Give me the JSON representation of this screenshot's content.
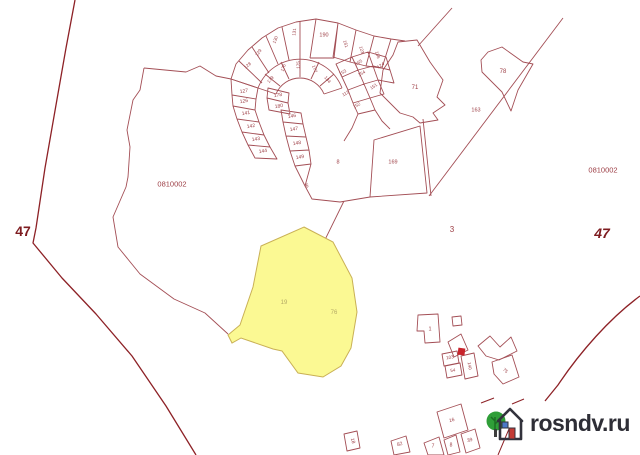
{
  "watermark": {
    "text": "rosndv.ru",
    "logo": "tree-and-house-icon"
  },
  "colors": {
    "parcel_line": "#a34e55",
    "district_line": "#8d2126",
    "district_text": "#7e1c20",
    "label_text": "#9c3d44",
    "highlight_fill": "#fbf993",
    "highlight_stroke": "#c9b055",
    "highlight_label": "#b4aa66",
    "red_marker": "#c8232b",
    "watermark_text": "#2e2e36",
    "tree_green": "#2f9e38"
  },
  "labels": [
    {
      "t": "47",
      "x": 23,
      "y": 231,
      "s": 14,
      "w": "bold",
      "c": "#7e1c20",
      "n": "district-label-left"
    },
    {
      "t": "47",
      "x": 602,
      "y": 233,
      "s": 14,
      "w": "bold",
      "i": true,
      "c": "#7e1c20",
      "n": "district-label-right"
    },
    {
      "t": "0810002",
      "x": 172,
      "y": 184,
      "s": 7.5,
      "n": "quarter-label-left"
    },
    {
      "t": "0810002",
      "x": 603,
      "y": 170,
      "s": 7.5,
      "n": "quarter-label-right"
    },
    {
      "t": "3",
      "x": 452,
      "y": 230,
      "s": 8,
      "n": "area-label"
    },
    {
      "t": "71",
      "x": 415,
      "y": 88,
      "s": 6
    },
    {
      "t": "78",
      "x": 503,
      "y": 72,
      "s": 6
    },
    {
      "t": "163",
      "x": 476,
      "y": 111,
      "s": 5.5
    },
    {
      "t": "169",
      "x": 393,
      "y": 163,
      "s": 5.5
    },
    {
      "t": "6",
      "x": 307,
      "y": 187,
      "s": 5.5
    },
    {
      "t": "8",
      "x": 338,
      "y": 163,
      "s": 5.5
    },
    {
      "t": "127",
      "x": 244,
      "y": 92,
      "s": 5,
      "r": -8
    },
    {
      "t": "126",
      "x": 244,
      "y": 102,
      "s": 5,
      "r": -8
    },
    {
      "t": "141",
      "x": 246,
      "y": 114,
      "s": 5,
      "r": -8
    },
    {
      "t": "142",
      "x": 251,
      "y": 127,
      "s": 5,
      "r": -8
    },
    {
      "t": "143",
      "x": 256,
      "y": 140,
      "s": 5,
      "r": -8
    },
    {
      "t": "144",
      "x": 263,
      "y": 152,
      "s": 5,
      "r": -8
    },
    {
      "t": "178",
      "x": 278,
      "y": 96,
      "s": 5,
      "r": -8
    },
    {
      "t": "180",
      "x": 279,
      "y": 107,
      "s": 5,
      "r": -8
    },
    {
      "t": "146",
      "x": 292,
      "y": 117,
      "s": 5,
      "r": -8
    },
    {
      "t": "147",
      "x": 294,
      "y": 130,
      "s": 5,
      "r": -8
    },
    {
      "t": "148",
      "x": 297,
      "y": 144,
      "s": 5,
      "r": -8
    },
    {
      "t": "149",
      "x": 300,
      "y": 158,
      "s": 5,
      "r": -8
    },
    {
      "t": "128",
      "x": 248,
      "y": 66,
      "s": 4.5,
      "r": -40
    },
    {
      "t": "129",
      "x": 259,
      "y": 53,
      "s": 4.5,
      "r": -55
    },
    {
      "t": "130",
      "x": 276,
      "y": 40,
      "s": 4.5,
      "r": -70
    },
    {
      "t": "131",
      "x": 295,
      "y": 32,
      "s": 4.5,
      "r": -85
    },
    {
      "t": "190",
      "x": 324,
      "y": 36,
      "s": 5.5
    },
    {
      "t": "161",
      "x": 345,
      "y": 44,
      "s": 4.5,
      "r": 75
    },
    {
      "t": "123",
      "x": 361,
      "y": 50,
      "s": 4.5,
      "r": 75
    },
    {
      "t": "136",
      "x": 377,
      "y": 55,
      "s": 4.5,
      "r": 75
    },
    {
      "t": "179",
      "x": 271,
      "y": 80,
      "s": 4.5,
      "r": -50
    },
    {
      "t": "176",
      "x": 284,
      "y": 68,
      "s": 4.5,
      "r": -70
    },
    {
      "t": "175",
      "x": 299,
      "y": 65,
      "s": 4.5,
      "r": -88
    },
    {
      "t": "177",
      "x": 314,
      "y": 69,
      "s": 4.5,
      "r": 70
    },
    {
      "t": "134",
      "x": 327,
      "y": 80,
      "s": 4.5,
      "r": 50
    },
    {
      "t": "153",
      "x": 343,
      "y": 73,
      "s": 4.5,
      "r": -30
    },
    {
      "t": "165",
      "x": 359,
      "y": 63,
      "s": 4.5,
      "r": -30
    },
    {
      "t": "154",
      "x": 362,
      "y": 74,
      "s": 4.5,
      "r": -30
    },
    {
      "t": "124",
      "x": 381,
      "y": 66,
      "s": 4.5,
      "r": -35
    },
    {
      "t": "151",
      "x": 374,
      "y": 87,
      "s": 4.5,
      "r": -35
    },
    {
      "t": "113",
      "x": 346,
      "y": 94,
      "s": 4.5,
      "r": -30
    },
    {
      "t": "152",
      "x": 357,
      "y": 106,
      "s": 4.5,
      "r": -30
    },
    {
      "t": "19",
      "x": 284,
      "y": 303,
      "s": 6,
      "c": "#b4aa66",
      "n": "highlight-parcel-label"
    },
    {
      "t": "76",
      "x": 334,
      "y": 313,
      "s": 6,
      "c": "#b4aa66",
      "n": "highlight-parcel-label"
    },
    {
      "t": "1",
      "x": 430,
      "y": 330,
      "s": 5.5
    },
    {
      "t": "103",
      "x": 450,
      "y": 358,
      "s": 4.5,
      "r": -10
    },
    {
      "t": "54",
      "x": 453,
      "y": 371,
      "s": 4.5,
      "r": -10
    },
    {
      "t": "140",
      "x": 469,
      "y": 366,
      "s": 4.5,
      "r": 80
    },
    {
      "t": "75",
      "x": 505,
      "y": 371,
      "s": 4.5,
      "r": 40
    },
    {
      "t": "18",
      "x": 352,
      "y": 441,
      "s": 5,
      "r": 75
    },
    {
      "t": "82",
      "x": 400,
      "y": 445,
      "s": 5,
      "r": -15
    },
    {
      "t": "7",
      "x": 433,
      "y": 447,
      "s": 5
    },
    {
      "t": "16",
      "x": 452,
      "y": 421,
      "s": 5,
      "r": -15
    },
    {
      "t": "8",
      "x": 451,
      "y": 446,
      "s": 5
    },
    {
      "t": "39",
      "x": 470,
      "y": 441,
      "s": 5,
      "r": -15
    }
  ]
}
